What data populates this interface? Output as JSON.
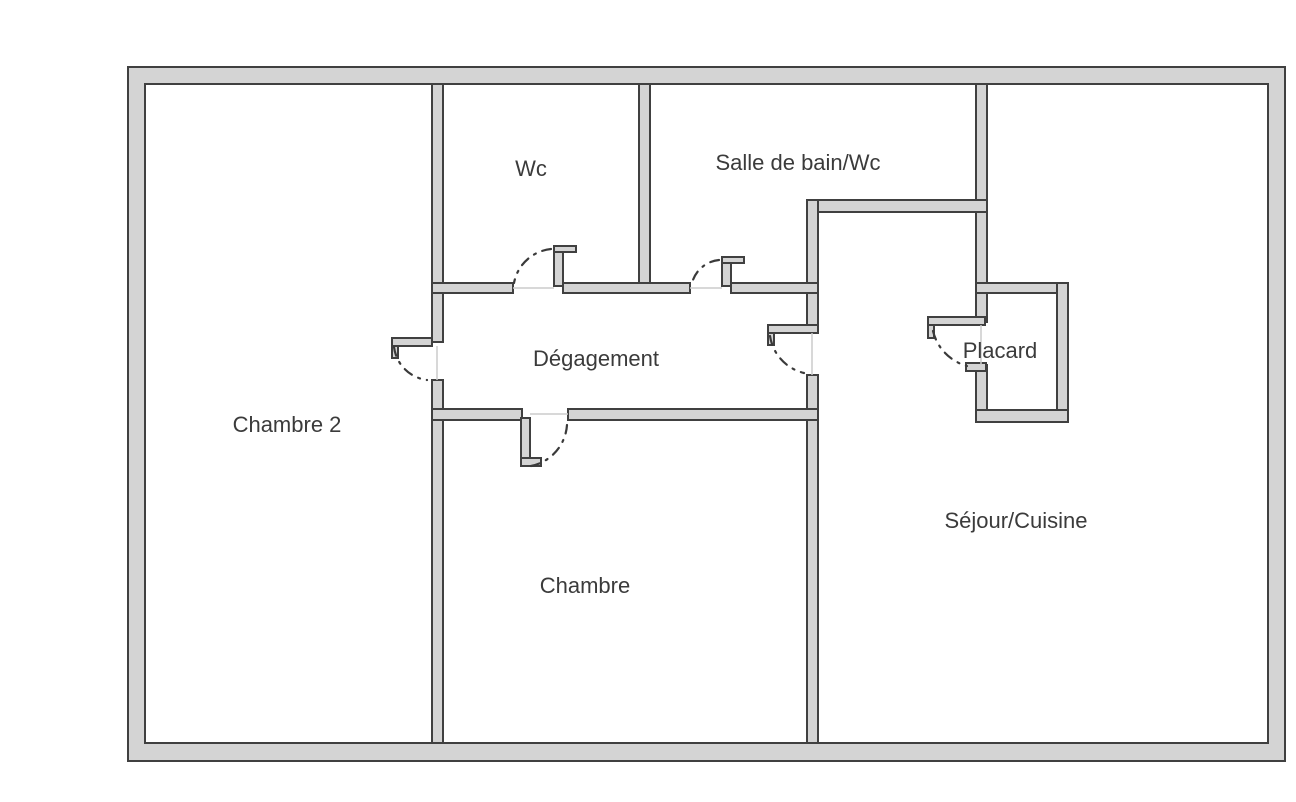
{
  "floor_plan": {
    "rooms": [
      {
        "label": "Chambre 2"
      },
      {
        "label": "Wc"
      },
      {
        "label": "Salle de bain/Wc"
      },
      {
        "label": "Dégagement"
      },
      {
        "label": "Chambre"
      },
      {
        "label": "Séjour/Cuisine"
      },
      {
        "label": "Placard"
      }
    ],
    "colors": {
      "background": "#ffffff",
      "wall_fill": "#d4d4d4",
      "wall_stroke": "#404040",
      "door_arc": "#3a3a3a",
      "threshold": "#cbcbcb",
      "label_text": "#3b3b3b"
    }
  }
}
